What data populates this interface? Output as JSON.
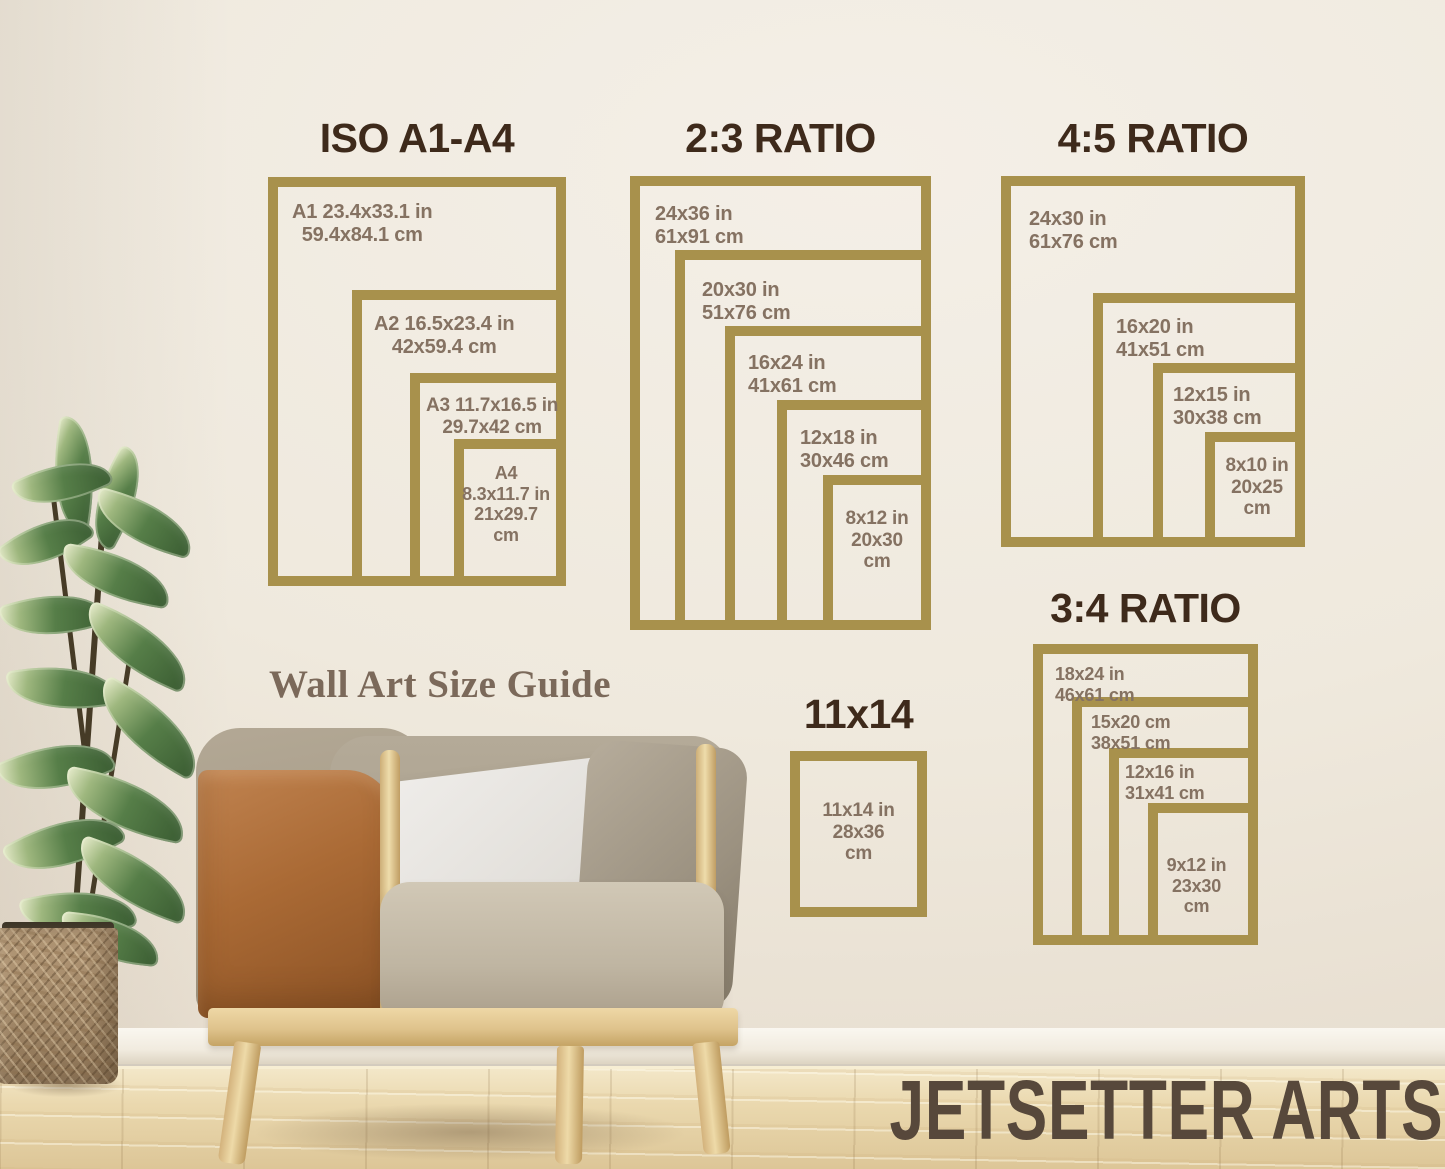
{
  "caption": "Wall Art Size Guide",
  "brand": "JETSETTER ARTS",
  "colors": {
    "frame_gold": "#a8914c",
    "title_brown": "#3e2a1b",
    "label_brown": "#857262",
    "caption_brown": "#7b695a",
    "brand_brown": "#57483b"
  },
  "charts": [
    {
      "title": "ISO A1-A4",
      "frames": [
        {
          "lines": [
            "A1 23.4x33.1 in",
            "59.4x84.1 cm"
          ]
        },
        {
          "lines": [
            "A2 16.5x23.4 in",
            "42x59.4 cm"
          ]
        },
        {
          "lines": [
            "A3 11.7x16.5 in",
            "29.7x42 cm"
          ]
        },
        {
          "lines": [
            "A4",
            "8.3x11.7 in",
            "21x29.7",
            "cm"
          ]
        }
      ]
    },
    {
      "title": "2:3 RATIO",
      "frames": [
        {
          "lines": [
            "24x36 in",
            "61x91 cm"
          ]
        },
        {
          "lines": [
            "20x30 in",
            "51x76 cm"
          ]
        },
        {
          "lines": [
            "16x24 in",
            "41x61 cm"
          ]
        },
        {
          "lines": [
            "12x18 in",
            "30x46 cm"
          ]
        },
        {
          "lines": [
            "8x12 in",
            "20x30",
            "cm"
          ]
        }
      ]
    },
    {
      "title": "4:5 RATIO",
      "frames": [
        {
          "lines": [
            "24x30 in",
            "61x76 cm"
          ]
        },
        {
          "lines": [
            "16x20 in",
            "41x51 cm"
          ]
        },
        {
          "lines": [
            "12x15 in",
            "30x38 cm"
          ]
        },
        {
          "lines": [
            "8x10 in",
            "20x25",
            "cm"
          ]
        }
      ]
    },
    {
      "title": "3:4 RATIO",
      "frames": [
        {
          "lines": [
            "18x24 in",
            "46x61 cm"
          ]
        },
        {
          "lines": [
            "15x20 cm",
            "38x51 cm"
          ]
        },
        {
          "lines": [
            "12x16 in",
            "31x41 cm"
          ]
        },
        {
          "lines": [
            "9x12 in",
            "23x30",
            "cm"
          ]
        }
      ]
    },
    {
      "title": "11x14",
      "frames": [
        {
          "lines": [
            "11x14 in",
            "28x36",
            "cm"
          ]
        }
      ]
    }
  ]
}
